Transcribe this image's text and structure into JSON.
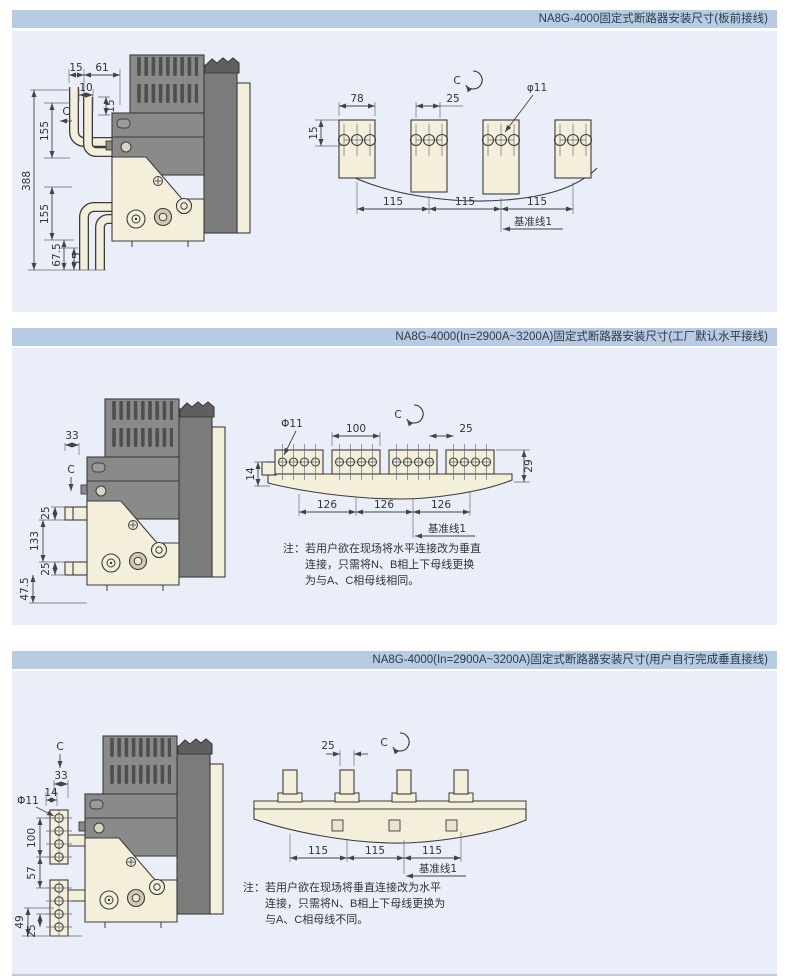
{
  "colors": {
    "header_bg": "#b7cbe3",
    "panel_bg": "#e9eef8",
    "outline": "#3c3c3c",
    "busbar_cream": "#f4efda",
    "breaker_gray": "#8a8a8a"
  },
  "panels": [
    {
      "title": "NA8G-4000固定式断路器安装尺寸(板前接线)",
      "side": {
        "w15": "15",
        "w61": "61",
        "w10": "10",
        "section": "C",
        "h15_top": "15",
        "h155_top": "155",
        "h388": "388",
        "h155_bot": "155",
        "h67_5": "67.5",
        "h15_bot": "15"
      },
      "bus": {
        "w78": "78",
        "section": "C",
        "w25": "25",
        "hole": "φ11",
        "h15": "15",
        "pitch": "115",
        "datum": "基准线1"
      }
    },
    {
      "title": "NA8G-4000(In=2900A~3200A)固定式断路器安装尺寸(工厂默认水平接线)",
      "side": {
        "w33": "33",
        "section": "C",
        "h25_top": "25",
        "h133": "133",
        "h25_bot": "25",
        "h47_5": "47.5"
      },
      "bus": {
        "hole": "Φ11",
        "w100": "100",
        "section": "C",
        "w25": "25",
        "h29": "29",
        "h14": "14",
        "pitch": "126",
        "datum": "基准线1"
      },
      "note": [
        "注：若用户欲在现场将水平连接改为垂直",
        "连接，只需将N、B相上下母线更换",
        "为与A、C相母线相同。"
      ]
    },
    {
      "title": "NA8G-4000(In=2900A~3200A)固定式断路器安装尺寸(用户自行完成垂直接线)",
      "side": {
        "section": "C",
        "w33": "33",
        "w14": "14",
        "hole": "Φ11",
        "h100": "100",
        "h57": "57",
        "h49": "49",
        "h25": "25"
      },
      "bus": {
        "w25": "25",
        "section": "C",
        "pitch": "115",
        "datum": "基准线1"
      },
      "note": [
        "注：若用户欲在现场将垂直连接改为水平",
        "连接，只需将N、B相上下母线更换为",
        "与A、C相母线不同。"
      ]
    }
  ]
}
